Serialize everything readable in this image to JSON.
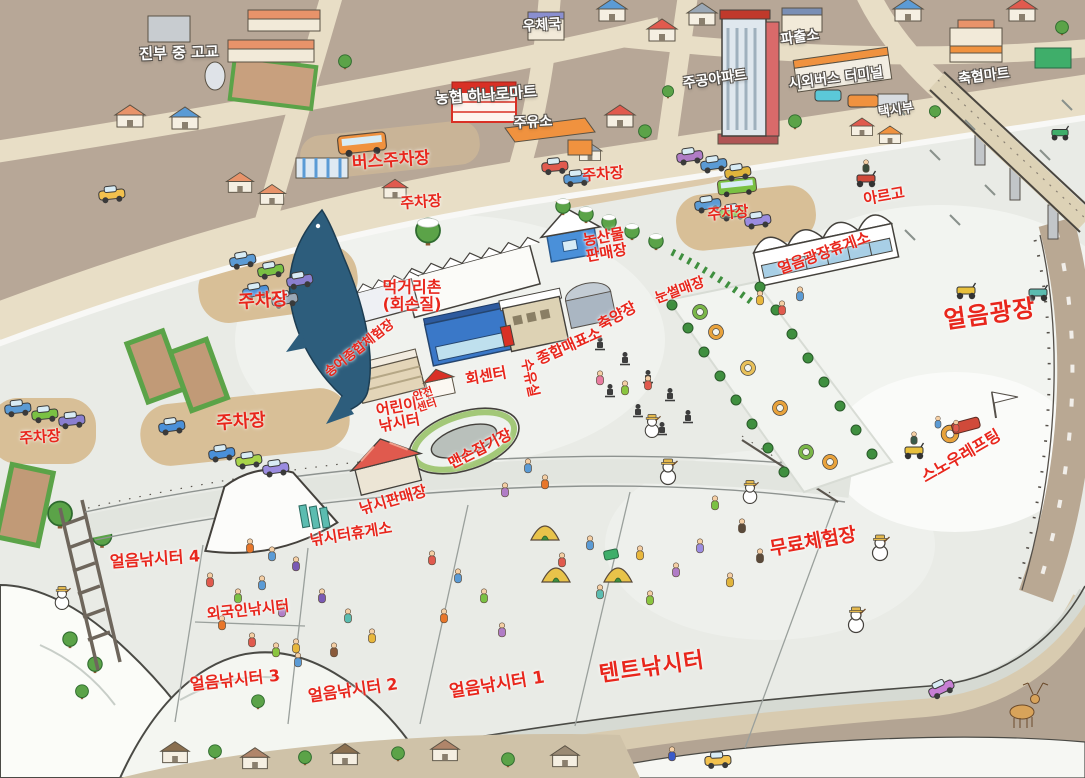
{
  "labels": {
    "jinbu_school": "진부 중 고교",
    "post_office": "우체국",
    "hanaro_mart": "농협 하나로마트",
    "gas_station": "주유소",
    "police_box": "파출소",
    "jugong_apt": "주공아파트",
    "bus_terminal": "시외버스 터미널",
    "chukhyup_mart": "축협마트",
    "taxi_stand": "택시부",
    "bus_parking": "버스주차장",
    "parking": "주차장",
    "argo": "아르고",
    "ice_plaza_rest": "얼음광장휴게소",
    "ice_plaza": "얼음광장",
    "food_village_line1": "먹거리촌",
    "food_village_line2": "(회손질)",
    "farm_market_line1": "농산물",
    "farm_market_line2": "판매장",
    "sled_hill": "눈썰매장",
    "fish_farm": "축양장",
    "ticket_office": "종합매표소",
    "nursing_room": "수유실",
    "hoe_center": "회센터",
    "trout_hall": "송어종합체험장",
    "kids_fishing_line1": "어린이",
    "kids_fishing_line2": "낚시터",
    "safety_center_line1": "안전",
    "safety_center_line2": "센터",
    "barehand": "맨손잡기장",
    "fishing_shop": "낚시판매장",
    "fishing_rest": "낚시터휴게소",
    "snow_rafting": "스노우레프팅",
    "free_experience": "무료체험장",
    "ice_fishing_4": "얼음낚시터 4",
    "foreigner_fishing": "외국인낚시터",
    "ice_fishing_3": "얼음낚시터 3",
    "ice_fishing_2": "얼음낚시터 2",
    "ice_fishing_1": "얼음낚시터 1",
    "tent_fishing": "텐트낚시터"
  },
  "colors": {
    "label_red": "#e8261c",
    "label_white": "#ffffff",
    "town_ground": "#b7a797",
    "road": "#e8dec6",
    "snow": "#e9ebe6",
    "ice": "#f3f5f1",
    "parking_tan": "#d8bf97",
    "tree_green": "#5ba348",
    "fish_blue": "#2d5d7c"
  },
  "illustrations": [
    "trout-fish-icon",
    "bridge",
    "snowman-icon",
    "deer-icon",
    "mountain-range",
    "fishing-tents",
    "cars",
    "bus",
    "atv-icon",
    "sled-tube-icon",
    "skate-sled-icon",
    "school-field",
    "apartment-tower",
    "weir-ladder"
  ]
}
